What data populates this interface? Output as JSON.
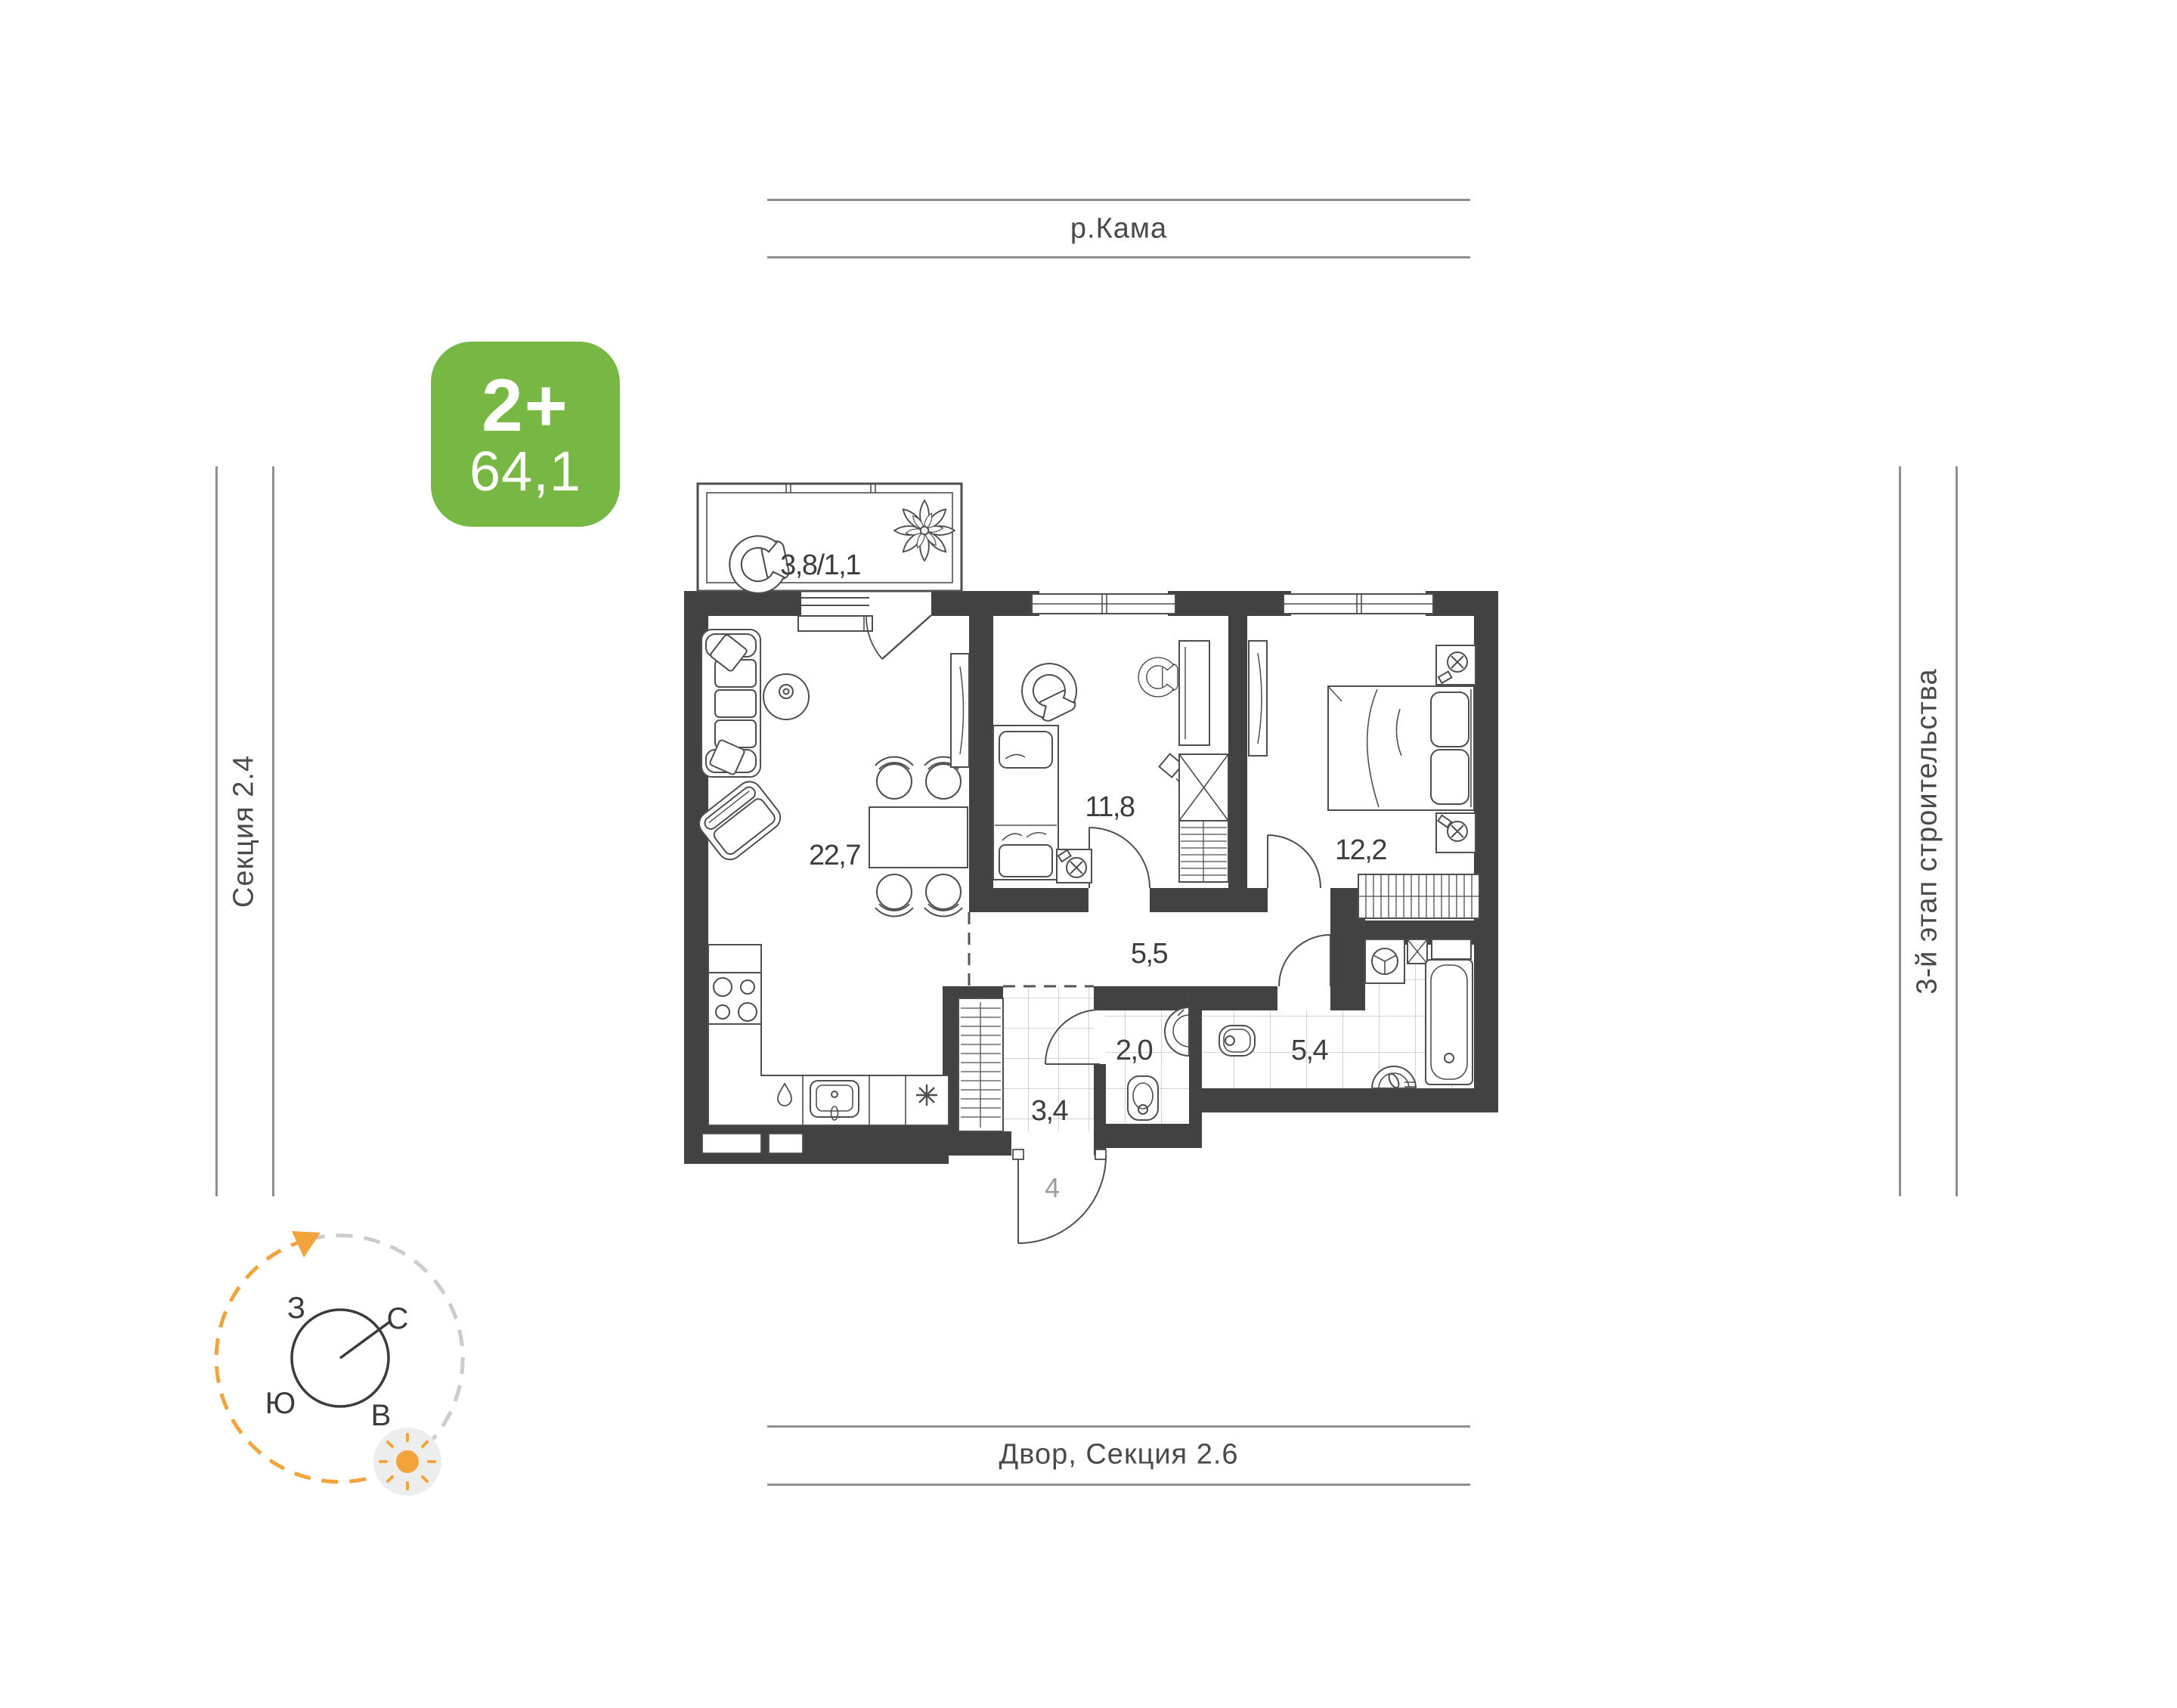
{
  "badge": {
    "type_label": "2+",
    "area_value": "64,1"
  },
  "surroundings": {
    "top": "р.Кама",
    "bottom": "Двор, Секция 2.6",
    "left": "Секция 2.4",
    "right": "3-й этап строительства"
  },
  "rooms": [
    {
      "name": "balcony",
      "label": "3,8/1,1"
    },
    {
      "name": "living-kitchen",
      "label": "22,7"
    },
    {
      "name": "bedroom-1",
      "label": "11,8"
    },
    {
      "name": "bedroom-2",
      "label": "12,2"
    },
    {
      "name": "corridor",
      "label": "5,5"
    },
    {
      "name": "wc",
      "label": "2,0"
    },
    {
      "name": "hall",
      "label": "3,4"
    },
    {
      "name": "bathroom",
      "label": "5,4"
    }
  ],
  "entry": {
    "label": "4"
  },
  "compass": {
    "west": "З",
    "north": "С",
    "south": "Ю",
    "east": "В"
  },
  "colors": {
    "badge_green": "#76B843",
    "compass_orange": "#F2A33C",
    "wall_dark": "#424242",
    "guide_line_gray": "#8f8f8f"
  }
}
